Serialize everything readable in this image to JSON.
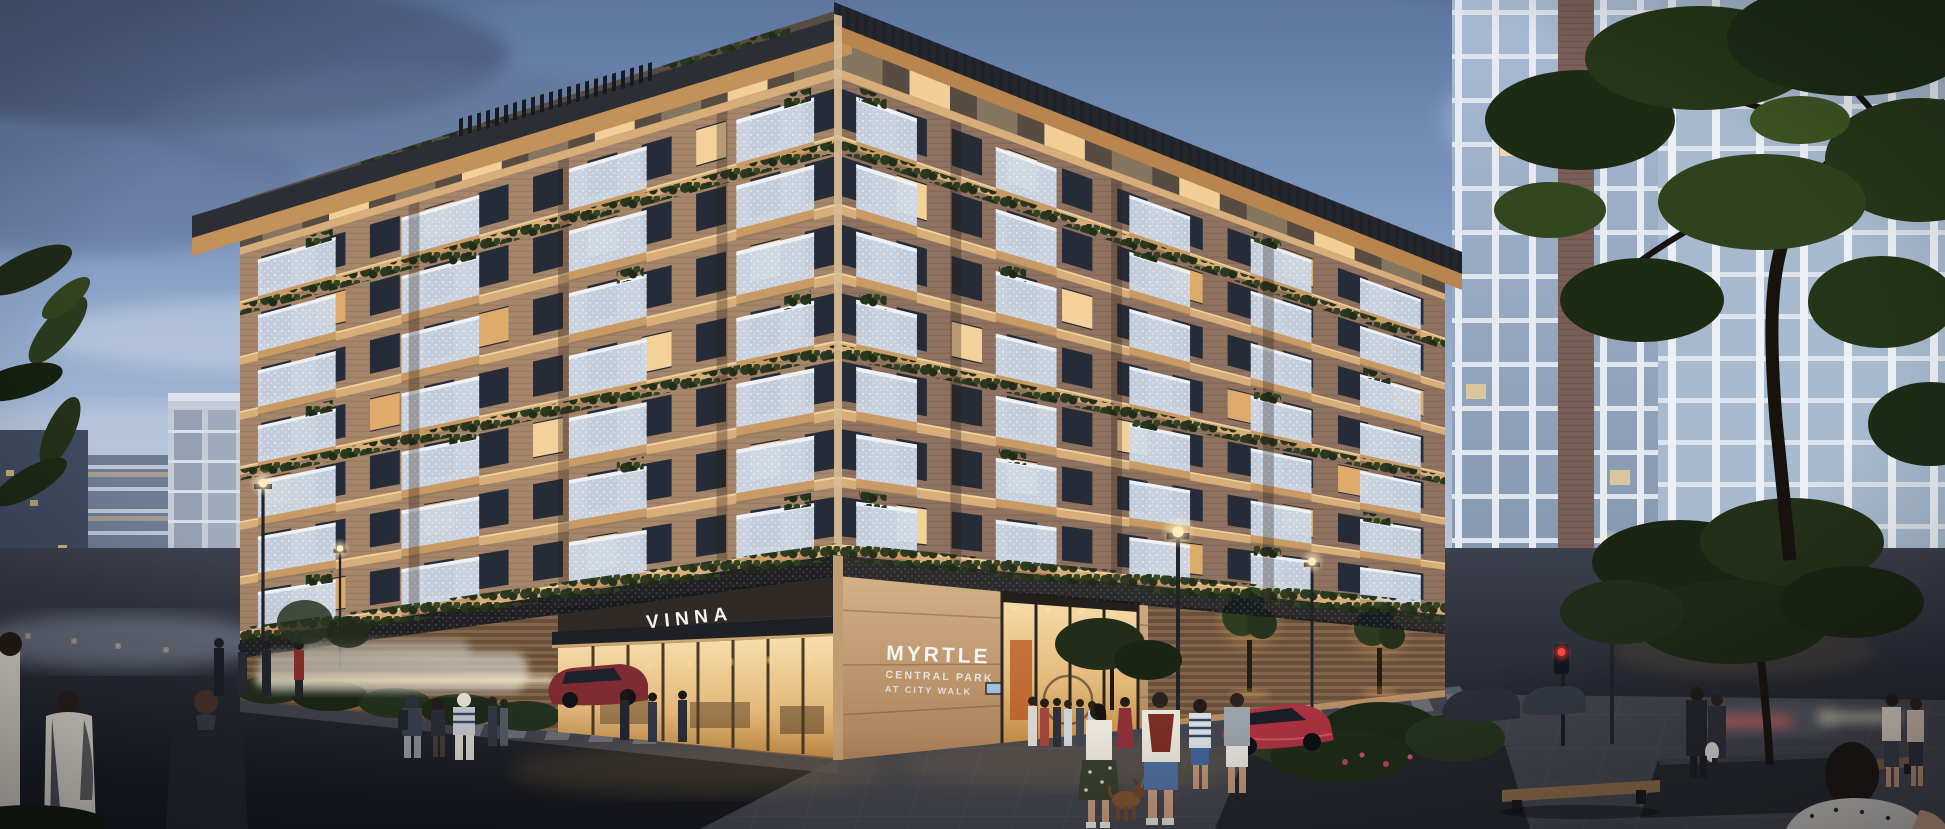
{
  "signs": {
    "vinna": "VINNA",
    "myrtle_name": "MYRTLE",
    "myrtle_sub1": "CENTRAL PARK",
    "myrtle_sub2": "AT CITY WALK"
  },
  "palette": {
    "sky_top": "#5d76a0",
    "sky_mid": "#8aa3c6",
    "sky_horizon": "#c9d3e2",
    "cloud_dark": "#4b5c7c",
    "wall_left": "#a6866a",
    "wall_right": "#8f7260",
    "penthouse": "#564c42",
    "pent_dim": "#8a7a62",
    "slab": "#d7ad7a",
    "soffit_lit": "#c89a66",
    "balcony_panel": "#ccd7e4",
    "balcony_rail": "#eef2f7",
    "window_dark": "#262c37",
    "window_lit": "#ffd9a0",
    "window_amber": "#e8b26e",
    "greenery": "#2c3b22",
    "roof_dark": "#23262c",
    "fascia_lit": "#c2925a",
    "stone": "#c9a276",
    "slat_wall": "#6e5238",
    "glass_warm_hi": "#f7dfae",
    "glass_warm_lo": "#c08b44",
    "tower_glass": "#9db1c9",
    "tower_pier": "#e6ebf1",
    "tower_brick": "#7a5f59",
    "road": "#3c404c",
    "road_dark": "#15171d",
    "plaza": "#43444d",
    "lamp_glow": "#ffeec2",
    "traffic_red": "#ff4840",
    "car_red": "#ab3240",
    "car_taxi": "#cfcabf",
    "skin": "#c79b80",
    "denim": "#4f6f9e",
    "backpack_maroon": "#7c2d24"
  }
}
